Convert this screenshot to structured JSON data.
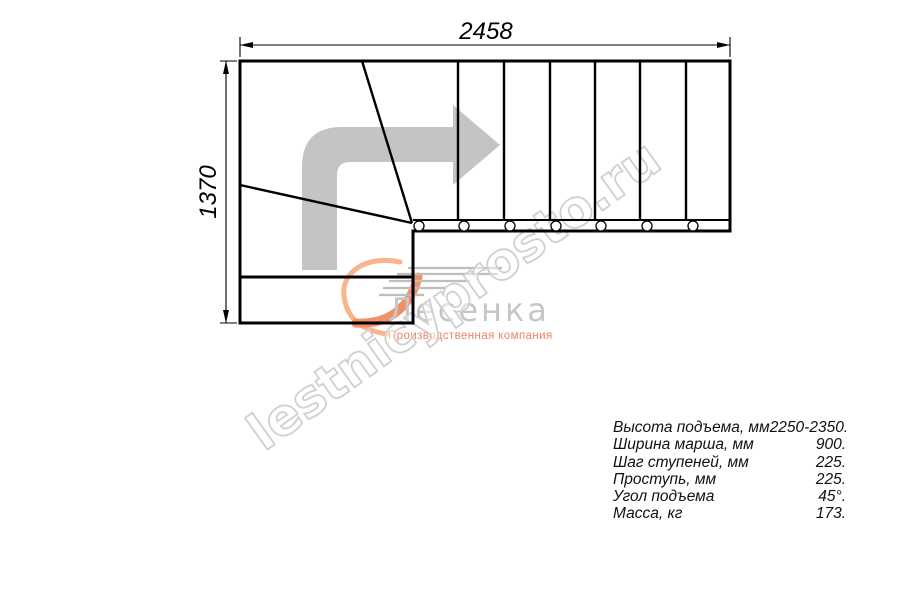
{
  "diagram": {
    "title_hint": "L-shaped staircase plan view",
    "dim_width_label": "2458",
    "dim_height_label": "1370",
    "direction_arrow_icon": "turn-right-arrow-icon"
  },
  "watermark": {
    "text": "lestnicyprosto.ru"
  },
  "logo": {
    "name": "Лесенка",
    "tagline": "Производственная компания"
  },
  "specs": {
    "rows": [
      {
        "label": "Высота подъема, мм",
        "value": "2250-2350."
      },
      {
        "label": "Ширина марша, мм",
        "value": "900."
      },
      {
        "label": "Шаг ступеней, мм",
        "value": "225."
      },
      {
        "label": "Проступь, мм",
        "value": "225."
      },
      {
        "label": "Угол подъема",
        "value": "45°."
      },
      {
        "label": "Масса, кг",
        "value": "173."
      }
    ]
  },
  "colors": {
    "line": "#000000",
    "arrow_fill": "#c4c4c4",
    "watermark_stroke": "#d0d0d0",
    "logo_name": "#c6c6c6",
    "logo_accent": "#ee8263",
    "swoosh_light": "#f8b48c",
    "swoosh_dark": "#f09066"
  }
}
